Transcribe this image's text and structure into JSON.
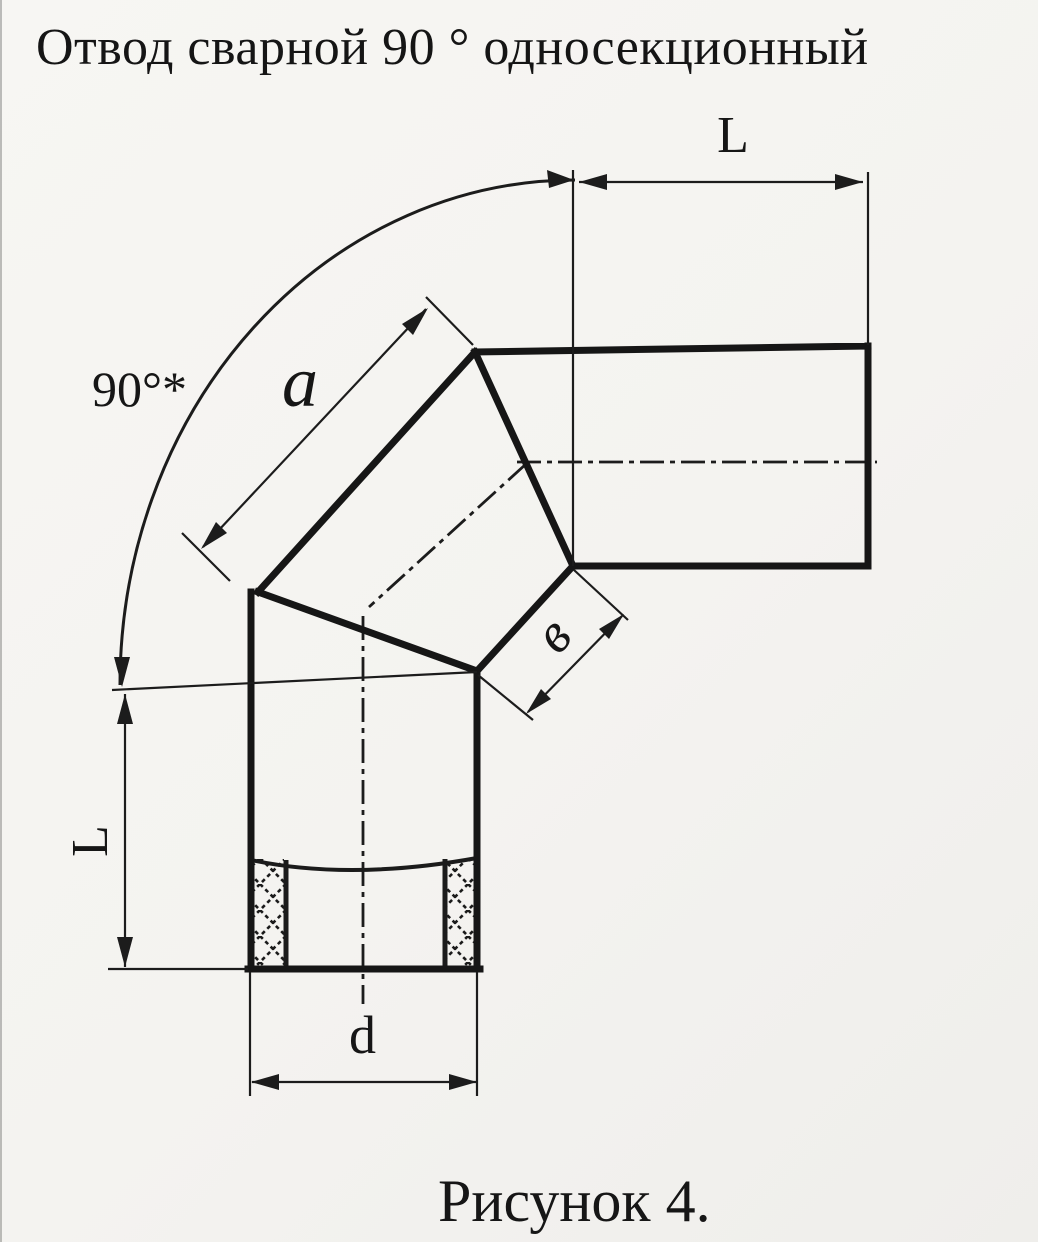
{
  "title": "Отвод сварной 90 ° односекционный",
  "caption": "Рисунок 4.",
  "dimensions": {
    "length_top": "L",
    "length_left": "L",
    "angle": "90°*",
    "outer_side": "a",
    "inner_side": "в",
    "diameter": "d"
  },
  "colors": {
    "ink": "#1a1a1a",
    "paper": "#f5f4f1"
  }
}
